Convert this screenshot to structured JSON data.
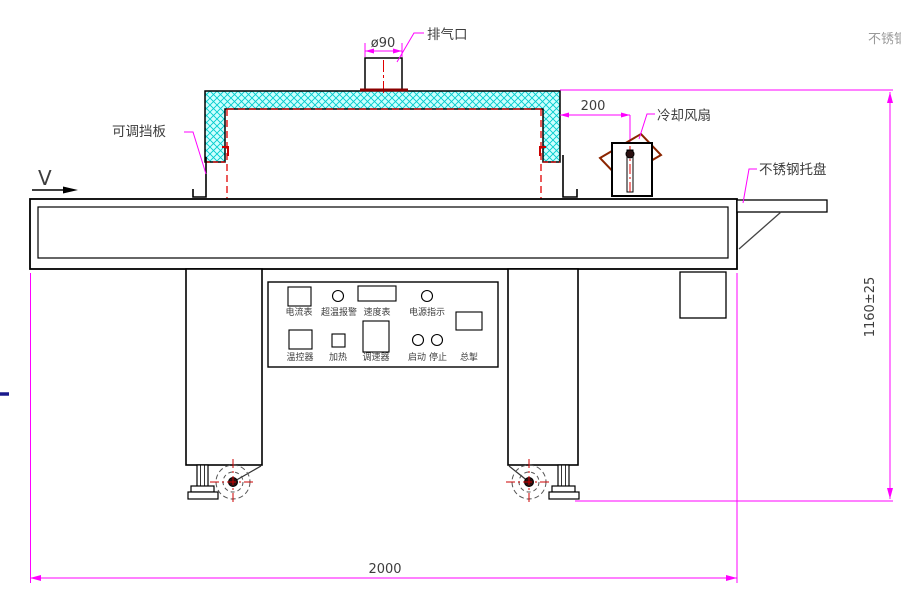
{
  "labels": {
    "velocity": "V",
    "exhaust_port": "排气口",
    "adjustable_baffle": "可调挡板",
    "cooling_fan": "冷却风扇",
    "stainless_tray": "不锈钢托盘",
    "stainless_corner": "不锈钢"
  },
  "dimensions": {
    "chimney_diameter": "ø90",
    "fan_offset": "200",
    "total_length": "2000",
    "height": "1160±25"
  },
  "control_panel": {
    "ammeter": "电流表",
    "overtemp_alarm": "超温报警",
    "speed_meter": "速度表",
    "power_indicator": "电源指示",
    "temp_controller": "温控器",
    "heating": "加热",
    "speed_regulator": "调速器",
    "start": "启动",
    "stop": "停止",
    "main_switch": "总掣"
  },
  "colors": {
    "dimension_line": "#FF00FF",
    "centerline_red": "#E00000",
    "hatch_fill": "#CCFFFF",
    "hatch_line": "#00CCCC",
    "outline": "#000000",
    "fan_blade": "#8B2500",
    "text": "#3D3D3D",
    "corner_text": "#999999",
    "edge_mark": "#1A1A8C"
  }
}
